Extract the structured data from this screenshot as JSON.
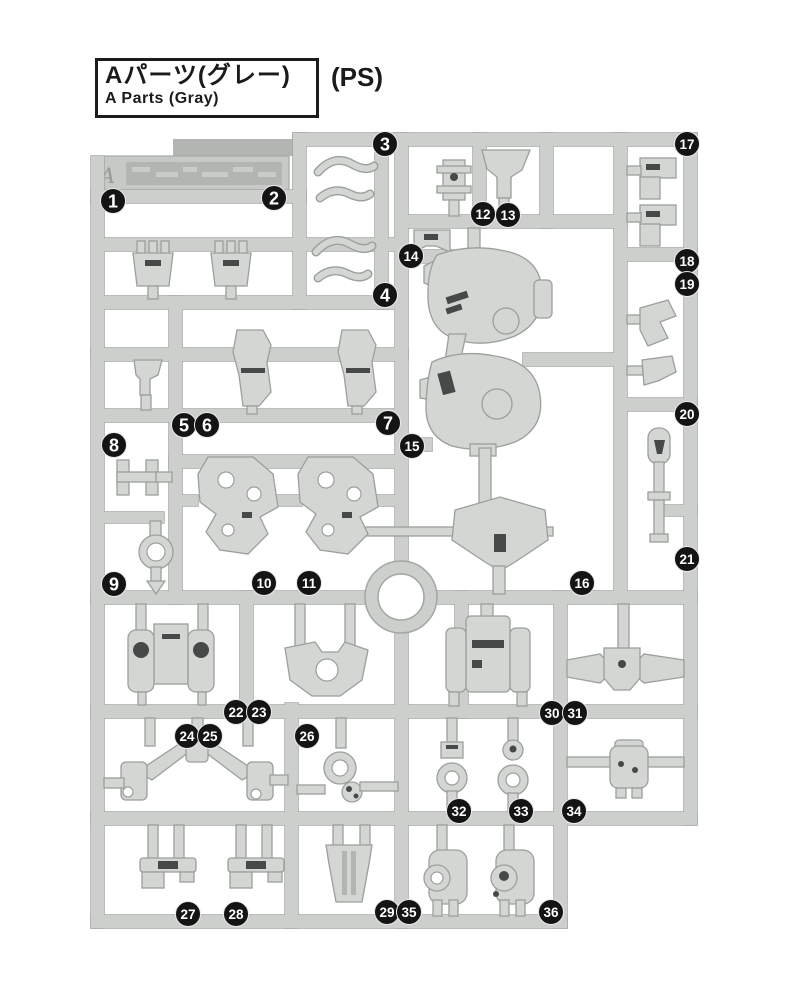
{
  "header": {
    "title_jp": "Aパーツ(グレー)",
    "title_en": "A Parts (Gray)",
    "material": "(PS)"
  },
  "sprue": {
    "tab_letter": "A",
    "colors": {
      "runner": "#cccfcc",
      "runner_border": "#a3a8a4",
      "part": "#d3d6d3",
      "badge": "#141414",
      "badge_text": "#ffffff"
    },
    "part_badges": [
      {
        "n": 1,
        "x": 113,
        "y": 201
      },
      {
        "n": 2,
        "x": 274,
        "y": 198
      },
      {
        "n": 3,
        "x": 385,
        "y": 144
      },
      {
        "n": 4,
        "x": 385,
        "y": 295
      },
      {
        "n": 5,
        "x": 184,
        "y": 425
      },
      {
        "n": 6,
        "x": 207,
        "y": 425
      },
      {
        "n": 7,
        "x": 388,
        "y": 423
      },
      {
        "n": 8,
        "x": 114,
        "y": 445
      },
      {
        "n": 9,
        "x": 114,
        "y": 584
      },
      {
        "n": 10,
        "x": 264,
        "y": 583
      },
      {
        "n": 11,
        "x": 309,
        "y": 583
      },
      {
        "n": 12,
        "x": 483,
        "y": 214
      },
      {
        "n": 13,
        "x": 508,
        "y": 215
      },
      {
        "n": 14,
        "x": 411,
        "y": 256
      },
      {
        "n": 15,
        "x": 412,
        "y": 446
      },
      {
        "n": 16,
        "x": 582,
        "y": 583
      },
      {
        "n": 17,
        "x": 687,
        "y": 144
      },
      {
        "n": 18,
        "x": 687,
        "y": 261
      },
      {
        "n": 19,
        "x": 687,
        "y": 284
      },
      {
        "n": 20,
        "x": 687,
        "y": 414
      },
      {
        "n": 21,
        "x": 687,
        "y": 559
      },
      {
        "n": 22,
        "x": 236,
        "y": 712
      },
      {
        "n": 23,
        "x": 259,
        "y": 712
      },
      {
        "n": 24,
        "x": 187,
        "y": 736
      },
      {
        "n": 25,
        "x": 210,
        "y": 736
      },
      {
        "n": 26,
        "x": 307,
        "y": 736
      },
      {
        "n": 27,
        "x": 188,
        "y": 914
      },
      {
        "n": 28,
        "x": 236,
        "y": 914
      },
      {
        "n": 29,
        "x": 387,
        "y": 912
      },
      {
        "n": 30,
        "x": 552,
        "y": 713
      },
      {
        "n": 31,
        "x": 575,
        "y": 713
      },
      {
        "n": 32,
        "x": 459,
        "y": 811
      },
      {
        "n": 33,
        "x": 521,
        "y": 811
      },
      {
        "n": 34,
        "x": 574,
        "y": 811
      },
      {
        "n": 35,
        "x": 409,
        "y": 912
      },
      {
        "n": 36,
        "x": 551,
        "y": 912
      }
    ]
  }
}
